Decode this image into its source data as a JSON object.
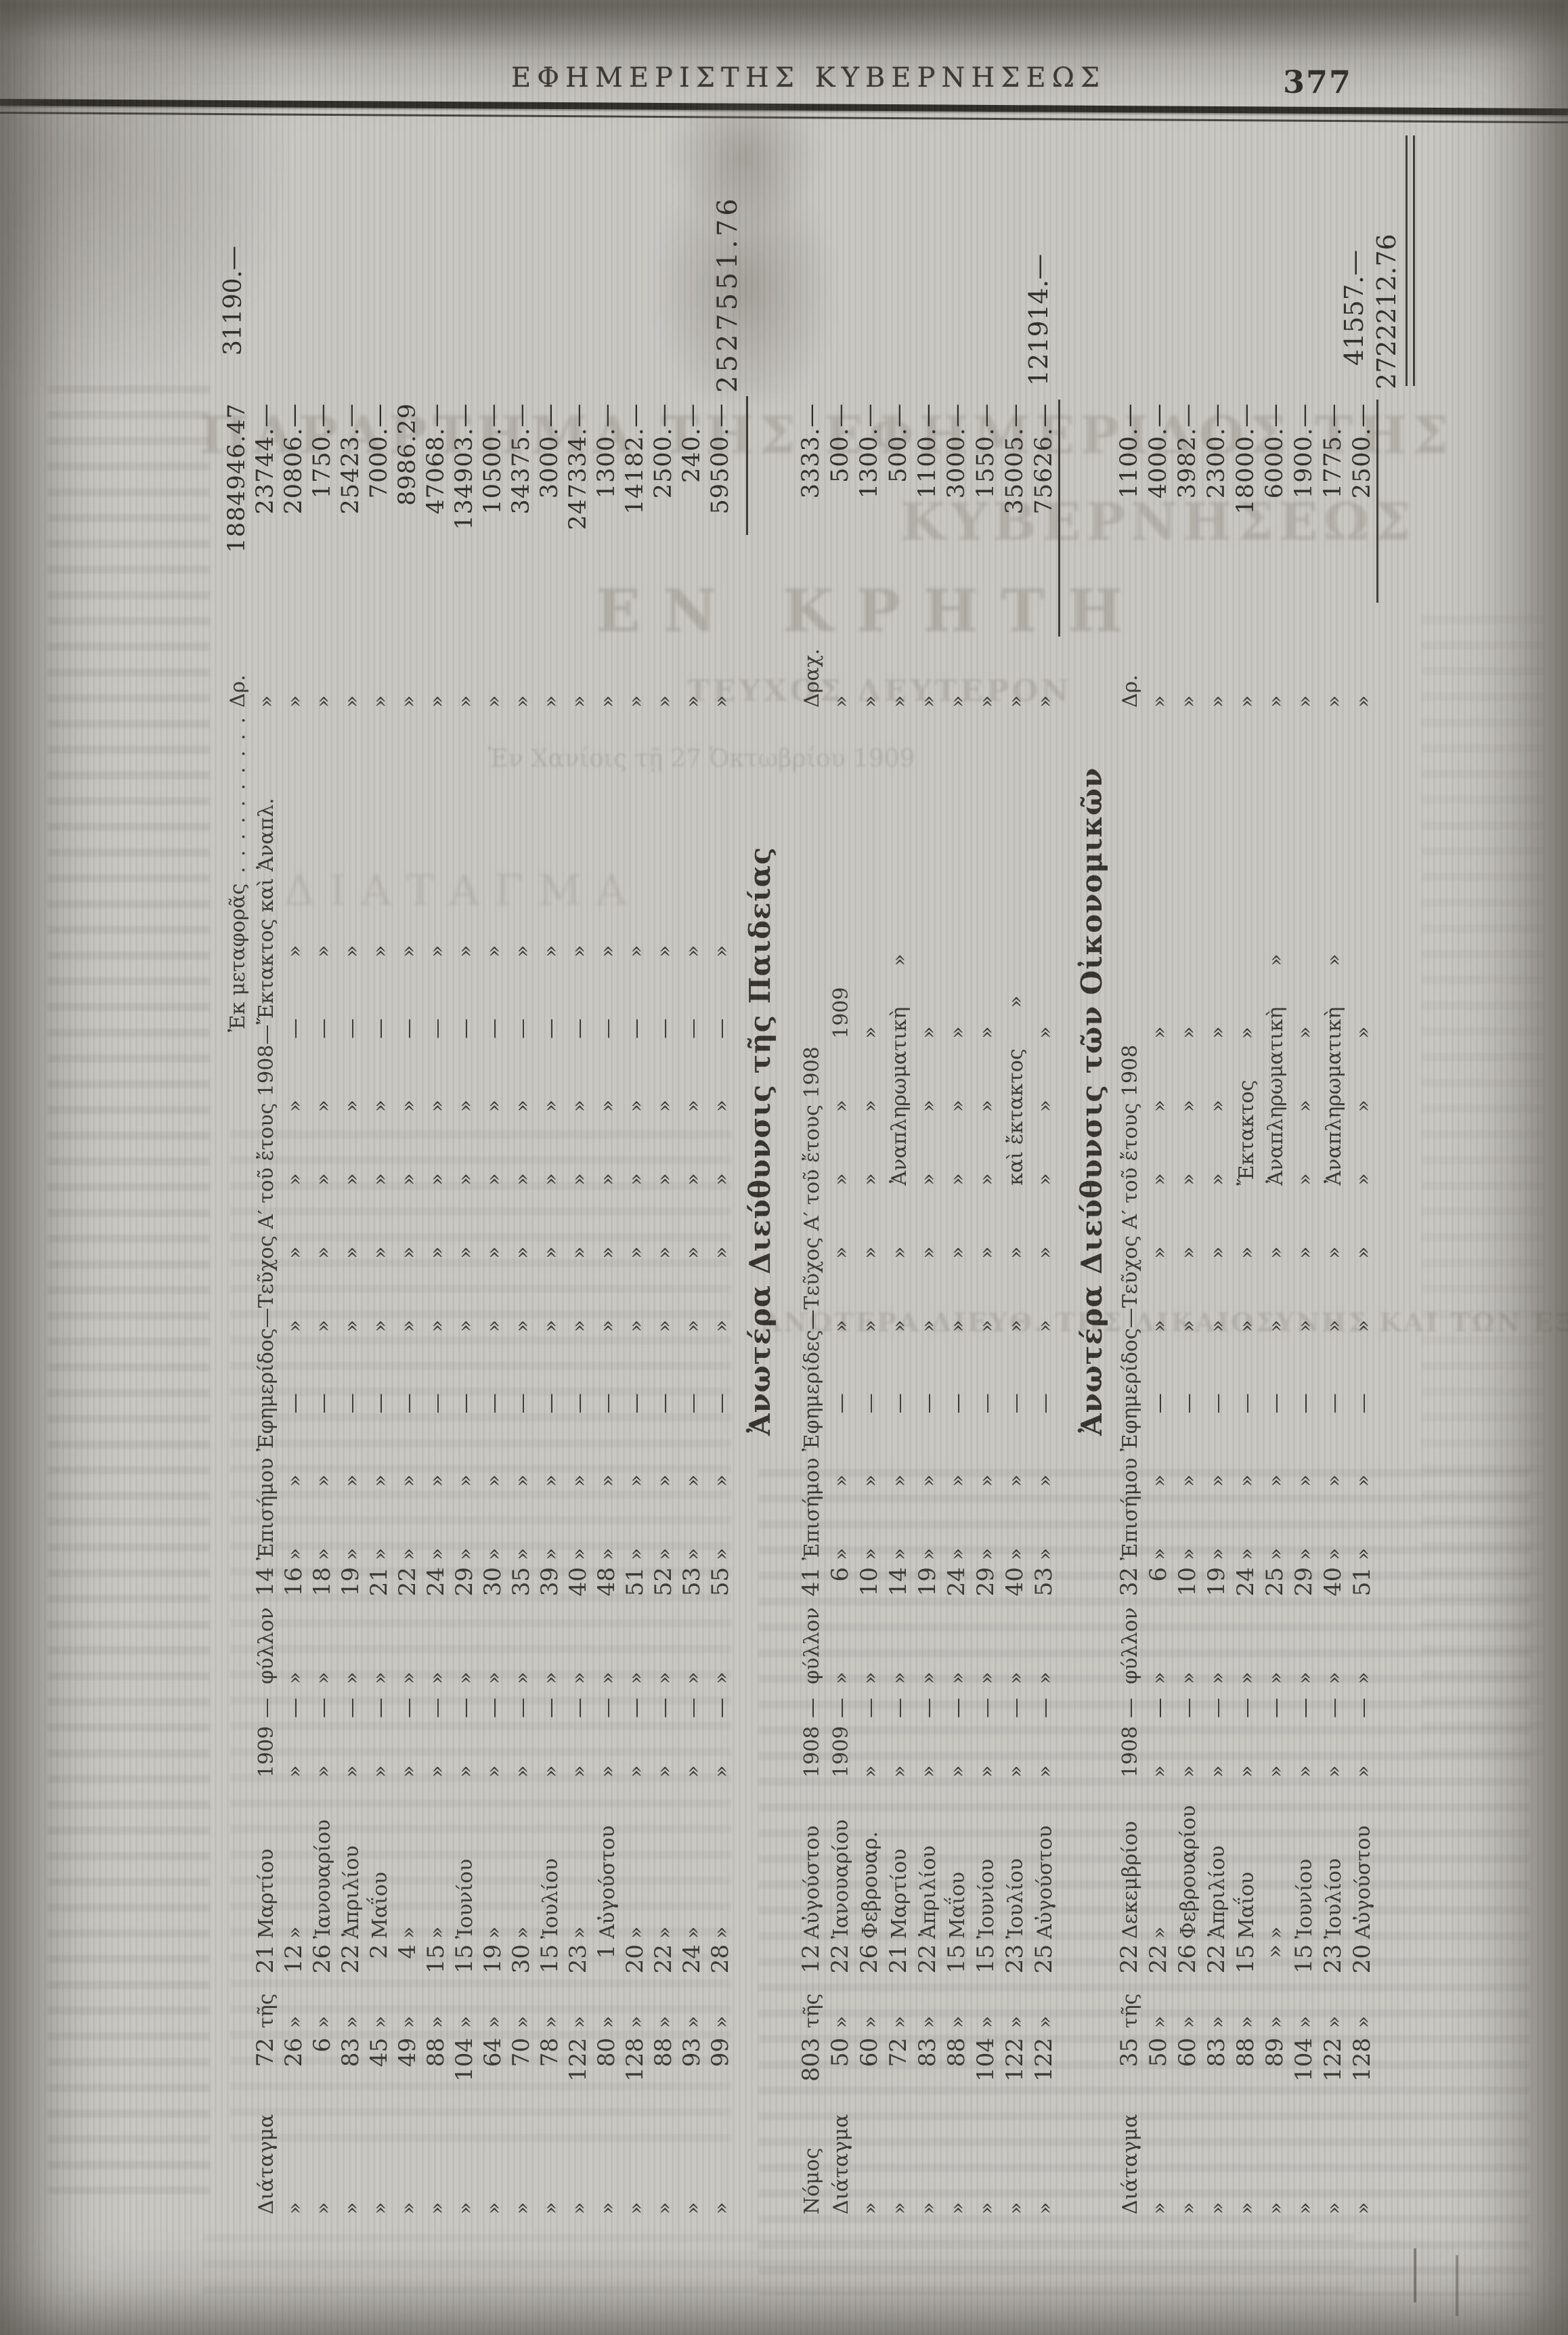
{
  "page": {
    "header_title": "ΕΦΗΜΕΡΙΣΤΗΣ ΚΥΒΕΡΝΗΣΕΩΣ",
    "page_number": "377"
  },
  "ghosts": {
    "parartima": "ΠΑΡΑΡΤΗΜΑ ΤΗΣ ΕΦΗΜΕΡΙΔΟΣ ΤΗΣ",
    "kyverniseos": "ΚΥΒΕΡΝΗΣΕΩΣ",
    "en_kriti": "ΕΝ ΚΡΗΤΗ",
    "teyxos": "ΤΕΥΧΟΣ ΔΕΥΤΕΡΟΝ",
    "date_line": "Ἐν Χανίοις τῇ 27 Ὀκτωβρίου 1909",
    "diatagma": "ΔΙΑΤΑΓΜΑ",
    "dikaiosynis": "ΑΝΩΤΕΡΑ ΔΙΕΥΘ. ΤΗΣ ΔΙΚΑΙΟΣΥΝΗΣ ΚΑΙ ΤΩΝ ΕΞΩΤΕΡΙΚΩΝ"
  },
  "tables": [
    {
      "name": "carried-forward-ledger",
      "note": "31190.—",
      "total": "2527551.76",
      "rows": [
        {
          "label": "",
          "num": "",
          "tis": "",
          "day": "",
          "month": "",
          "year": "",
          "dash": "",
          "fyl": "",
          "issue": "",
          "desc": "                          Ἐκ μεταφορᾶς . . . . . . . . . . . .",
          "cur": "Δρ.",
          "amount": "1884946.47"
        },
        {
          "label": "Διάταγμα",
          "num": "72",
          "tis": "τῆς",
          "day": "21",
          "month": "Μαρτίου",
          "year": "1909",
          "dash": "—",
          "fyl": "φύλλον",
          "issue": "14",
          "desc": "Ἐπισήμου Ἐφημερίδος—Τεῦχος Α′ τοῦ ἔτους 1908—Ἔκτακτος καὶ Ἀναπλ.",
          "cur": "»",
          "amount": "23744.—"
        },
        {
          "label": "»",
          "num": "26",
          "tis": "»",
          "day": "12",
          "month": "»",
          "year": "»",
          "dash": "—",
          "fyl": "»",
          "issue": "16",
          "desc": "»   »   —   »   »   »   »   —   »",
          "cur": "»",
          "amount": "20806.—"
        },
        {
          "label": "»",
          "num": "6",
          "tis": "»",
          "day": "26",
          "month": "Ἰανουαρίου",
          "year": "»",
          "dash": "—",
          "fyl": "»",
          "issue": "18",
          "desc": "»   »   —   »   »   »   »   —   »",
          "cur": "»",
          "amount": "1750.—"
        },
        {
          "label": "»",
          "num": "83",
          "tis": "»",
          "day": "22",
          "month": "Ἀπριλίου",
          "year": "»",
          "dash": "—",
          "fyl": "»",
          "issue": "19",
          "desc": "»   »   —   »   »   »   »   —   »",
          "cur": "»",
          "amount": "25423.—"
        },
        {
          "label": "»",
          "num": "45",
          "tis": "»",
          "day": "2",
          "month": "Μαΐου",
          "year": "»",
          "dash": "—",
          "fyl": "»",
          "issue": "21",
          "desc": "»   »   —   »   »   »   »   —   »",
          "cur": "»",
          "amount": "7000.—"
        },
        {
          "label": "»",
          "num": "49",
          "tis": "»",
          "day": "4",
          "month": "»",
          "year": "»",
          "dash": "—",
          "fyl": "»",
          "issue": "22",
          "desc": "»   »   —   »   »   »   »   —   »",
          "cur": "»",
          "amount": "8986.29"
        },
        {
          "label": "»",
          "num": "88",
          "tis": "»",
          "day": "15",
          "month": "»",
          "year": "»",
          "dash": "—",
          "fyl": "»",
          "issue": "24",
          "desc": "»   »   —   »   »   »   »   —   »",
          "cur": "»",
          "amount": "47068.—"
        },
        {
          "label": "»",
          "num": "104",
          "tis": "»",
          "day": "15",
          "month": "Ἰουνίου",
          "year": "»",
          "dash": "—",
          "fyl": "»",
          "issue": "29",
          "desc": "»   »   —   »   »   »   »   —   »",
          "cur": "»",
          "amount": "134903.—"
        },
        {
          "label": "»",
          "num": "64",
          "tis": "»",
          "day": "19",
          "month": "»",
          "year": "»",
          "dash": "—",
          "fyl": "»",
          "issue": "30",
          "desc": "»   »   —   »   »   »   »   —   »",
          "cur": "»",
          "amount": "10500.—"
        },
        {
          "label": "»",
          "num": "70",
          "tis": "»",
          "day": "30",
          "month": "»",
          "year": "»",
          "dash": "—",
          "fyl": "»",
          "issue": "35",
          "desc": "»   »   —   »   »   »   »   —   »",
          "cur": "»",
          "amount": "34375.—"
        },
        {
          "label": "»",
          "num": "78",
          "tis": "»",
          "day": "15",
          "month": "Ἰουλίου",
          "year": "»",
          "dash": "—",
          "fyl": "»",
          "issue": "39",
          "desc": "»   »   —   »   »   »   »   —   »",
          "cur": "»",
          "amount": "3000.—"
        },
        {
          "label": "»",
          "num": "122",
          "tis": "»",
          "day": "23",
          "month": "»",
          "year": "»",
          "dash": "—",
          "fyl": "»",
          "issue": "40",
          "desc": "»   »   —   »   »   »   »   —   »",
          "cur": "»",
          "amount": "247334.—"
        },
        {
          "label": "»",
          "num": "80",
          "tis": "»",
          "day": "1",
          "month": "Αὐγούστου",
          "year": "»",
          "dash": "—",
          "fyl": "»",
          "issue": "48",
          "desc": "»   »   —   »   »   »   »   —   »",
          "cur": "»",
          "amount": "1300.—"
        },
        {
          "label": "»",
          "num": "128",
          "tis": "»",
          "day": "20",
          "month": "»",
          "year": "»",
          "dash": "—",
          "fyl": "»",
          "issue": "51",
          "desc": "»   »   —   »   »   »   »   —   »",
          "cur": "»",
          "amount": "14182.—"
        },
        {
          "label": "»",
          "num": "88",
          "tis": "»",
          "day": "22",
          "month": "»",
          "year": "»",
          "dash": "—",
          "fyl": "»",
          "issue": "52",
          "desc": "»   »   —   »   »   »   »   —   »",
          "cur": "»",
          "amount": "2500.—"
        },
        {
          "label": "»",
          "num": "93",
          "tis": "»",
          "day": "24",
          "month": "»",
          "year": "»",
          "dash": "—",
          "fyl": "»",
          "issue": "53",
          "desc": "»   »   —   »   »   »   »   —   »",
          "cur": "»",
          "amount": "240.—"
        },
        {
          "label": "»",
          "num": "99",
          "tis": "»",
          "day": "28",
          "month": "»",
          "year": "»",
          "dash": "—",
          "fyl": "»",
          "issue": "55",
          "desc": "»   »   —   »   »   »   »   —   »",
          "cur": "»",
          "amount": "59500.—"
        }
      ]
    },
    {
      "name": "paideia-ledger",
      "heading": "Ἀνωτέρα Διεύθυνσις τῆς Παιδείας",
      "total": "121914.—",
      "rows": [
        {
          "label": "Νόμος",
          "num": "803",
          "tis": "τῆς",
          "day": "12",
          "month": "Αὐγούστου",
          "year": "1908",
          "dash": "—",
          "fyl": "φύλλον",
          "issue": "41",
          "desc": "Ἐπισήμου Ἐφημερίδες—Τεῦχος Α′ τοῦ ἔτους 1908",
          "cur": "Δραχ.",
          "amount": "3333.—"
        },
        {
          "label": "Διάταγμα",
          "num": "50",
          "tis": "»",
          "day": "22",
          "month": "Ἰανουαρίου",
          "year": "1909",
          "dash": "—",
          "fyl": "»",
          "issue": "6",
          "desc": "»   »   —   »   »   »   »   1909",
          "cur": "»",
          "amount": "500.—"
        },
        {
          "label": "»",
          "num": "60",
          "tis": "»",
          "day": "26",
          "month": "Φεβρουαρ.",
          "year": "»",
          "dash": "—",
          "fyl": "»",
          "issue": "10",
          "desc": "»   »   —   »   »   »   »   »",
          "cur": "»",
          "amount": "1300.—"
        },
        {
          "label": "»",
          "num": "72",
          "tis": "»",
          "day": "21",
          "month": "Μαρτίου",
          "year": "»",
          "dash": "—",
          "fyl": "»",
          "issue": "14",
          "desc": "»   »   —   »   »   Ἀναπληρωματικὴ  »",
          "cur": "»",
          "amount": "500.—"
        },
        {
          "label": "»",
          "num": "83",
          "tis": "»",
          "day": "22",
          "month": "Ἀπριλίου",
          "year": "»",
          "dash": "—",
          "fyl": "»",
          "issue": "19",
          "desc": "»   »   —   »   »   »   »   »",
          "cur": "»",
          "amount": "1100.—"
        },
        {
          "label": "»",
          "num": "88",
          "tis": "»",
          "day": "15",
          "month": "Μαΐου",
          "year": "»",
          "dash": "—",
          "fyl": "»",
          "issue": "24",
          "desc": "»   »   —   »   »   »   »   »",
          "cur": "»",
          "amount": "3000.—"
        },
        {
          "label": "»",
          "num": "104",
          "tis": "»",
          "day": "15",
          "month": "Ἰουνίου",
          "year": "»",
          "dash": "—",
          "fyl": "»",
          "issue": "29",
          "desc": "»   »   —   »   »   »   »   »",
          "cur": "»",
          "amount": "1550.—"
        },
        {
          "label": "»",
          "num": "122",
          "tis": "»",
          "day": "23",
          "month": "Ἰουλίου",
          "year": "»",
          "dash": "—",
          "fyl": "»",
          "issue": "40",
          "desc": "»   »   —   »   »   καὶ ἔκτακτος  »",
          "cur": "»",
          "amount": "35005.—"
        },
        {
          "label": "»",
          "num": "122",
          "tis": "»",
          "day": "25",
          "month": "Αὐγούστου",
          "year": "»",
          "dash": "—",
          "fyl": "»",
          "issue": "53",
          "desc": "»   »   —   »   »   »   »   »",
          "cur": "»",
          "amount": "75626.—"
        }
      ]
    },
    {
      "name": "oikonomika-ledger",
      "heading": "Ἀνωτέρα Διεύθυνσις τῶν Οἰκονομικῶν",
      "subtotal": "41557.—",
      "grand_total": "2722212.76",
      "rows": [
        {
          "label": "Διάταγμα",
          "num": "35",
          "tis": "τῆς",
          "day": "22",
          "month": "Δεκεμβρίου",
          "year": "1908",
          "dash": "—",
          "fyl": "φύλλον",
          "issue": "32",
          "desc": "Ἐπισήμου Ἐφημερίδος—Τεῦχος Α′ τοῦ ἔτους 1908",
          "cur": "Δρ.",
          "amount": "1100.—"
        },
        {
          "label": "»",
          "num": "50",
          "tis": "»",
          "day": "22",
          "month": "»",
          "year": "»",
          "dash": "—",
          "fyl": "»",
          "issue": "6",
          "desc": "»   »   —   »   »   »   »   »",
          "cur": "»",
          "amount": "4000.—"
        },
        {
          "label": "»",
          "num": "60",
          "tis": "»",
          "day": "26",
          "month": "Φεβρουαρίου",
          "year": "»",
          "dash": "—",
          "fyl": "»",
          "issue": "10",
          "desc": "»   »   —   »   »   »   »   »",
          "cur": "»",
          "amount": "3982.—"
        },
        {
          "label": "»",
          "num": "83",
          "tis": "»",
          "day": "22",
          "month": "Ἀπριλίου",
          "year": "»",
          "dash": "—",
          "fyl": "»",
          "issue": "19",
          "desc": "»   »   —   »   »   »   »   »",
          "cur": "»",
          "amount": "2300.—"
        },
        {
          "label": "»",
          "num": "88",
          "tis": "»",
          "day": "15",
          "month": "Μαΐου",
          "year": "»",
          "dash": "—",
          "fyl": "»",
          "issue": "24",
          "desc": "»   »   —   »   »   Ἔκτακτος  »",
          "cur": "»",
          "amount": "18000.—"
        },
        {
          "label": "»",
          "num": "89",
          "tis": "»",
          "day": "»",
          "month": "»",
          "year": "»",
          "dash": "—",
          "fyl": "»",
          "issue": "25",
          "desc": "»   »   —   »   »   Ἀναπληρωματικὴ  »",
          "cur": "»",
          "amount": "6000.—"
        },
        {
          "label": "»",
          "num": "104",
          "tis": "»",
          "day": "15",
          "month": "Ἰουνίου",
          "year": "»",
          "dash": "—",
          "fyl": "»",
          "issue": "29",
          "desc": "»   »   —   »   »   »   »   »",
          "cur": "»",
          "amount": "1900.—"
        },
        {
          "label": "»",
          "num": "122",
          "tis": "»",
          "day": "23",
          "month": "Ἰουλίου",
          "year": "»",
          "dash": "—",
          "fyl": "»",
          "issue": "40",
          "desc": "»   »   —   »   »   Ἀναπληρωματικὴ  »",
          "cur": "»",
          "amount": "1775.—"
        },
        {
          "label": "»",
          "num": "128",
          "tis": "»",
          "day": "20",
          "month": "Αὐγούστου",
          "year": "»",
          "dash": "—",
          "fyl": "»",
          "issue": "51",
          "desc": "»   »   —   »   »   »   »   »",
          "cur": "»",
          "amount": "2500.—"
        }
      ]
    }
  ]
}
